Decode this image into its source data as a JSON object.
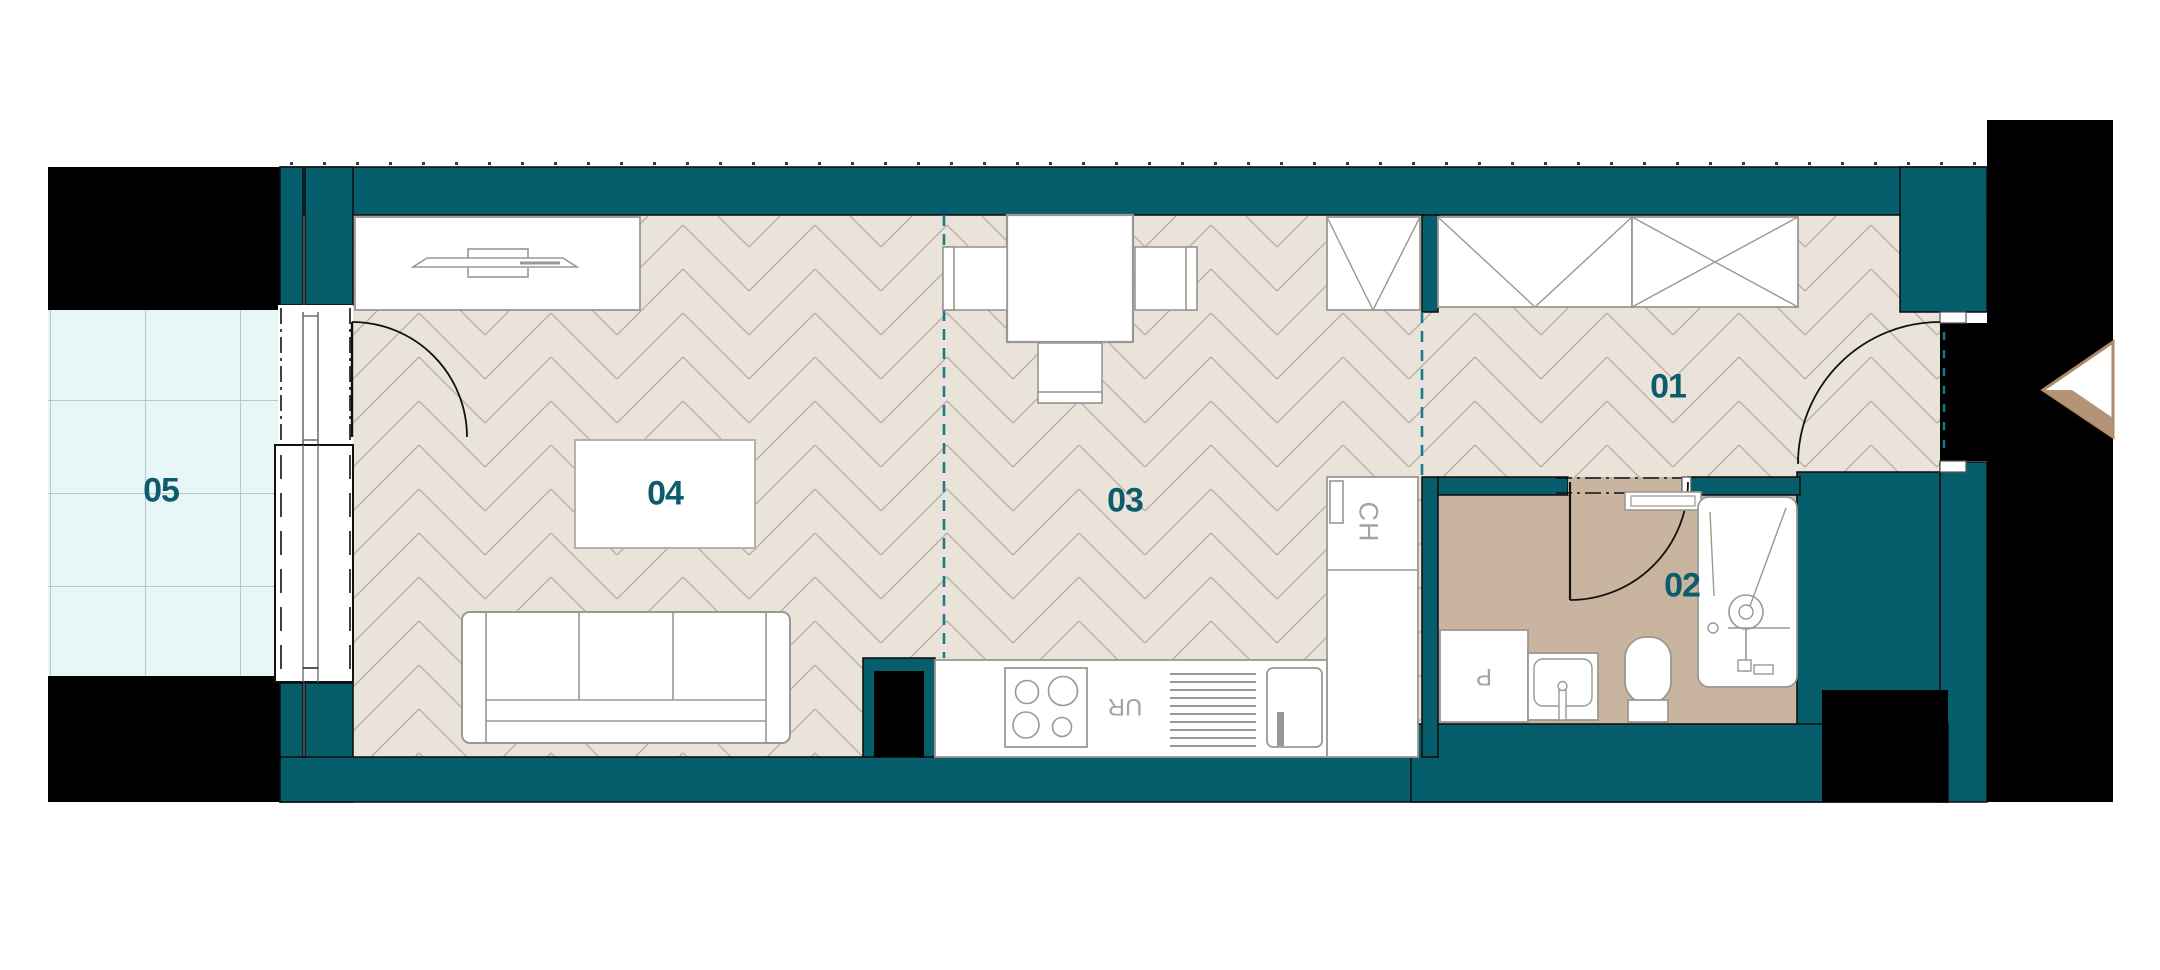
{
  "plan_title": "Apartment floor plan",
  "rooms": [
    {
      "id": "room-01",
      "label": "01"
    },
    {
      "id": "room-02",
      "label": "02"
    },
    {
      "id": "room-03",
      "label": "03"
    },
    {
      "id": "room-04",
      "label": "04"
    },
    {
      "id": "room-05",
      "label": "05"
    }
  ],
  "annotations": {
    "fridge_column": "CH",
    "dishwasher": "UR",
    "washing_machine": "P"
  },
  "colors": {
    "wall_teal": "#065e6d",
    "divider_teal": "#1b7a89",
    "label_teal": "#0d5c6c",
    "floor_beige": "#eae3da",
    "floor_line": "#b9b0a7",
    "bathroom_tan": "#c9b49f",
    "balcony_blue": "#e9f6f7",
    "balcony_line": "#b3c2c4",
    "structure_black": "#000000",
    "arrow_tan": "#b59377",
    "furniture_line": "#9b9893"
  }
}
